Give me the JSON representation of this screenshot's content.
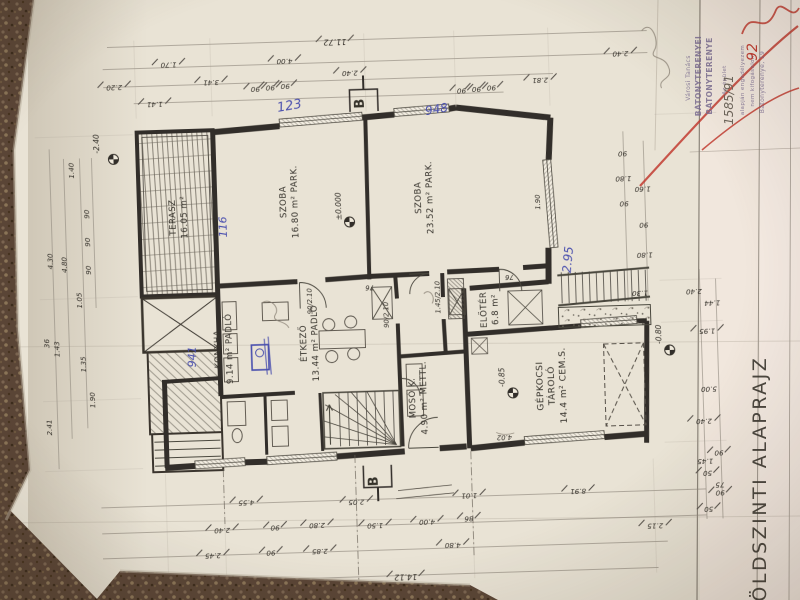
{
  "title": "FÖLDSZINTI ALAPRAJZ",
  "rooms": [
    {
      "name": "TERASZ",
      "area": "16.05 m²",
      "finish": ""
    },
    {
      "name": "SZOBA",
      "area": "16.80 m²",
      "finish": "PARK."
    },
    {
      "name": "SZOBA",
      "area": "23.52 m²",
      "finish": "PARK."
    },
    {
      "name": "KONYHA",
      "area": "9.14 m²",
      "finish": "PADLÓ"
    },
    {
      "name": "ÉTKEZŐ",
      "area": "13.44 m²",
      "finish": "PADLÓ"
    },
    {
      "name": "MOSÓ K.",
      "area": "4.90 m²",
      "finish": "METTL."
    },
    {
      "name": "ELŐTÉR",
      "area": "6.8 m²",
      "finish": ""
    },
    {
      "name": "GÉPKOCSI TÁROLÓ",
      "area": "14.4 m²",
      "finish": "CEM.S."
    }
  ],
  "levels": [
    "±0.000",
    "-0.85",
    "-0.80",
    "-2.40"
  ],
  "section_label": "B",
  "door_labels": [
    "76",
    "76",
    "90/2.10",
    "90/2.10",
    "1.45/2.10",
    "1.90",
    "4.02"
  ],
  "dims_top": [
    "11.72",
    "1.70",
    "4.00",
    "2.40",
    "2.40",
    "2.20",
    "3.41",
    "90",
    "90",
    "90",
    "2.81",
    "1.41",
    "90",
    "90",
    "90"
  ],
  "dims_left": [
    "1.40",
    "90",
    "90",
    "90",
    "4.30",
    "4.80",
    "1.05",
    "36",
    "1.43",
    "1.35",
    "1.90",
    "2.41"
  ],
  "dims_right": [
    "90",
    "1.80",
    "90",
    "1.60",
    "90",
    "1.80",
    "1.30",
    "2.40",
    "1.44",
    "5.00",
    "1.45",
    "75"
  ],
  "dims_bottom": [
    "4.55",
    "2.05",
    "1.01",
    "8.91",
    "2.40",
    "90",
    "2.80",
    "1.50",
    "4.00",
    "86",
    "2.15",
    "2.45",
    "90",
    "2.85",
    "4.80",
    "14.12",
    "2.40",
    "90",
    "50",
    "90",
    "50",
    "1.95"
  ],
  "annotations_blue": [
    "123",
    "948",
    "116",
    "2.95",
    "941"
  ],
  "annotation_pencil": "1585/91",
  "annotation_red": "92",
  "stamp_lines": [
    "Városi Tanács",
    "BÁTONYTERENYEI",
    "BÁTONYTERENYE",
    "Az épület",
    "alapján engedélyezem",
    "nem kifogásolom",
    "Bátonyterenye, 19"
  ],
  "colors": {
    "paper": "#e9e3d5",
    "carpet": "#5a4536",
    "ink": "#35312b",
    "blue": "#4a4fae",
    "red": "#c23d32",
    "stamp": "#7b6d92",
    "pencil": "#6e665c"
  }
}
